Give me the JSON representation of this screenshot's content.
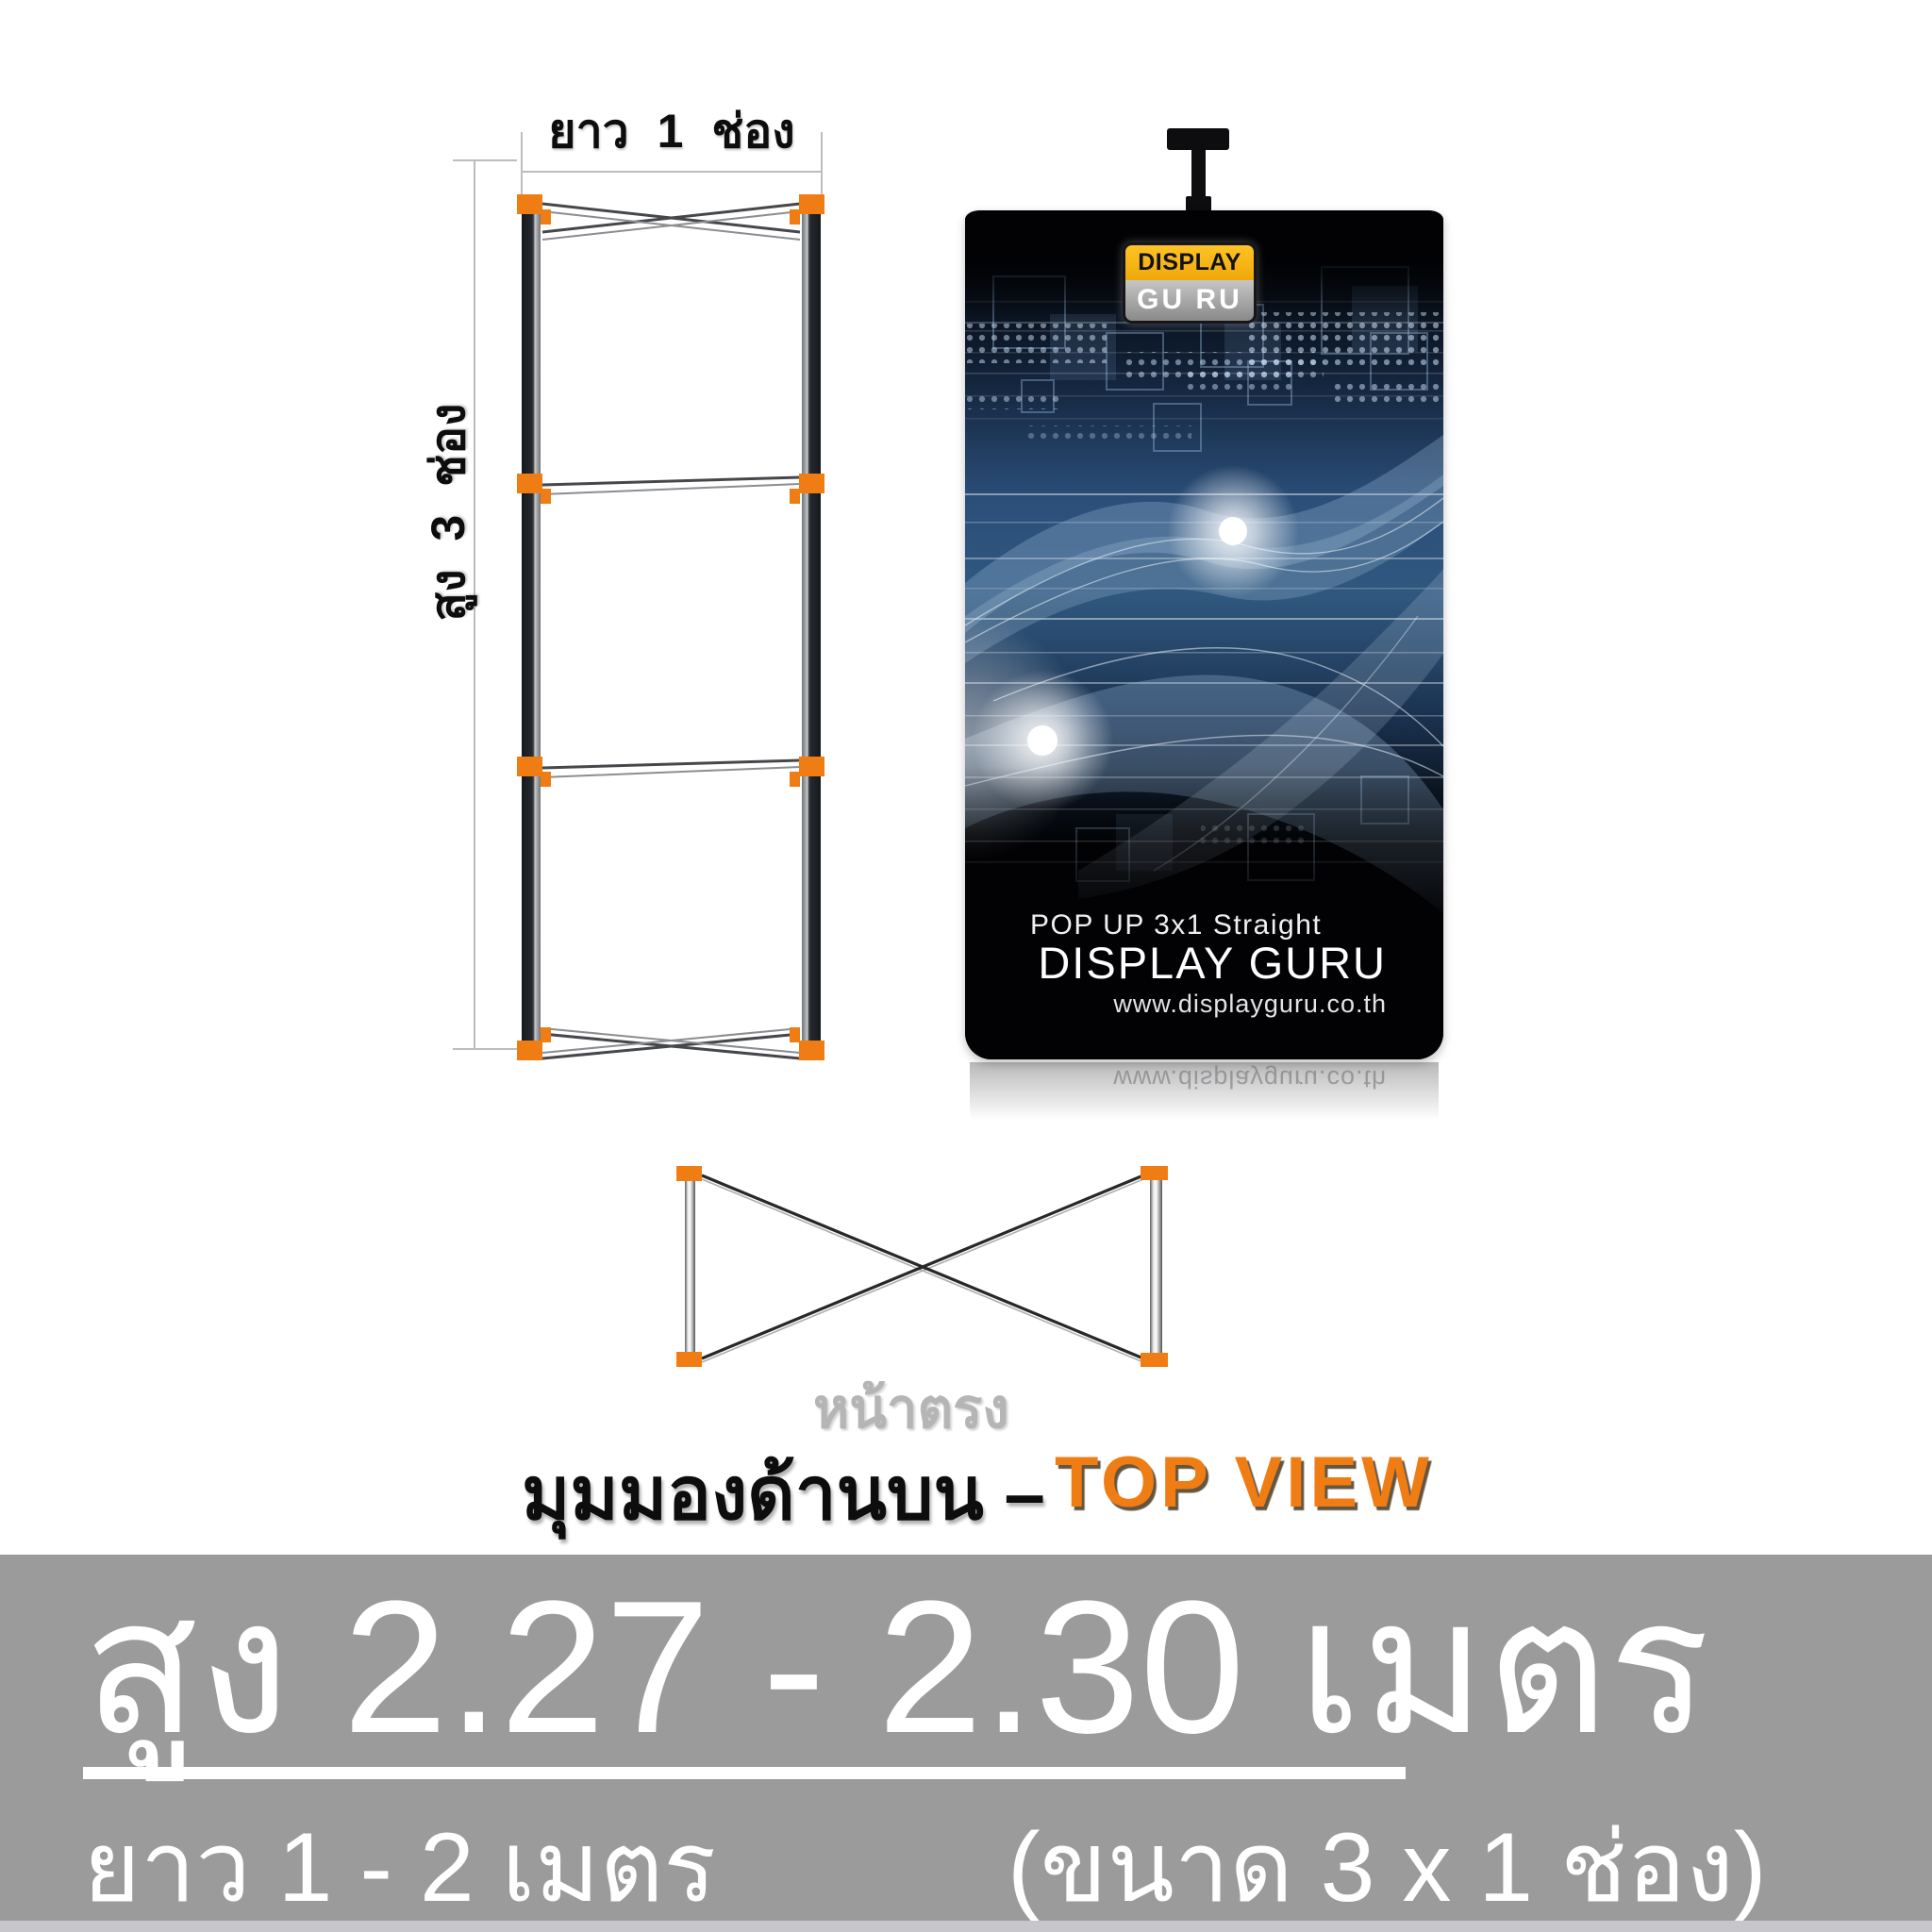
{
  "colors": {
    "orange": "#F07D14",
    "banner-gray": "#9B9B9B",
    "banner-strip": "#C7C7CB",
    "panel-black": "#020204",
    "logo-yellow": "#F5B50B",
    "logo-band-gray": "#9E9E9E",
    "dim-line-gray": "#BDBDBD",
    "graphic-blue": "#2B4F7A"
  },
  "front_view": {
    "width_label": "ยาว 1 ช่อง",
    "height_label": "สูง 3 ช่อง"
  },
  "display_panel": {
    "logo": {
      "top": "DISPLAY",
      "bottom": "GU RU"
    },
    "product_line": "POP UP 3x1 Straight",
    "brand": "DISPLAY GURU",
    "website": "www.displayguru.co.th",
    "reflection": "www.displayguru.co.th"
  },
  "top_view": {
    "front_label": "หน้าตรง",
    "caption_thai": "มุมมองด้านบน –",
    "caption_en": "TOP VIEW"
  },
  "spec_banner": {
    "height_spec": "สูง 2.27 - 2.30 เมตร",
    "length_spec": "ยาว 1 - 2 เมตร",
    "size_spec": "(ขนาด 3 x 1 ช่อง)"
  }
}
